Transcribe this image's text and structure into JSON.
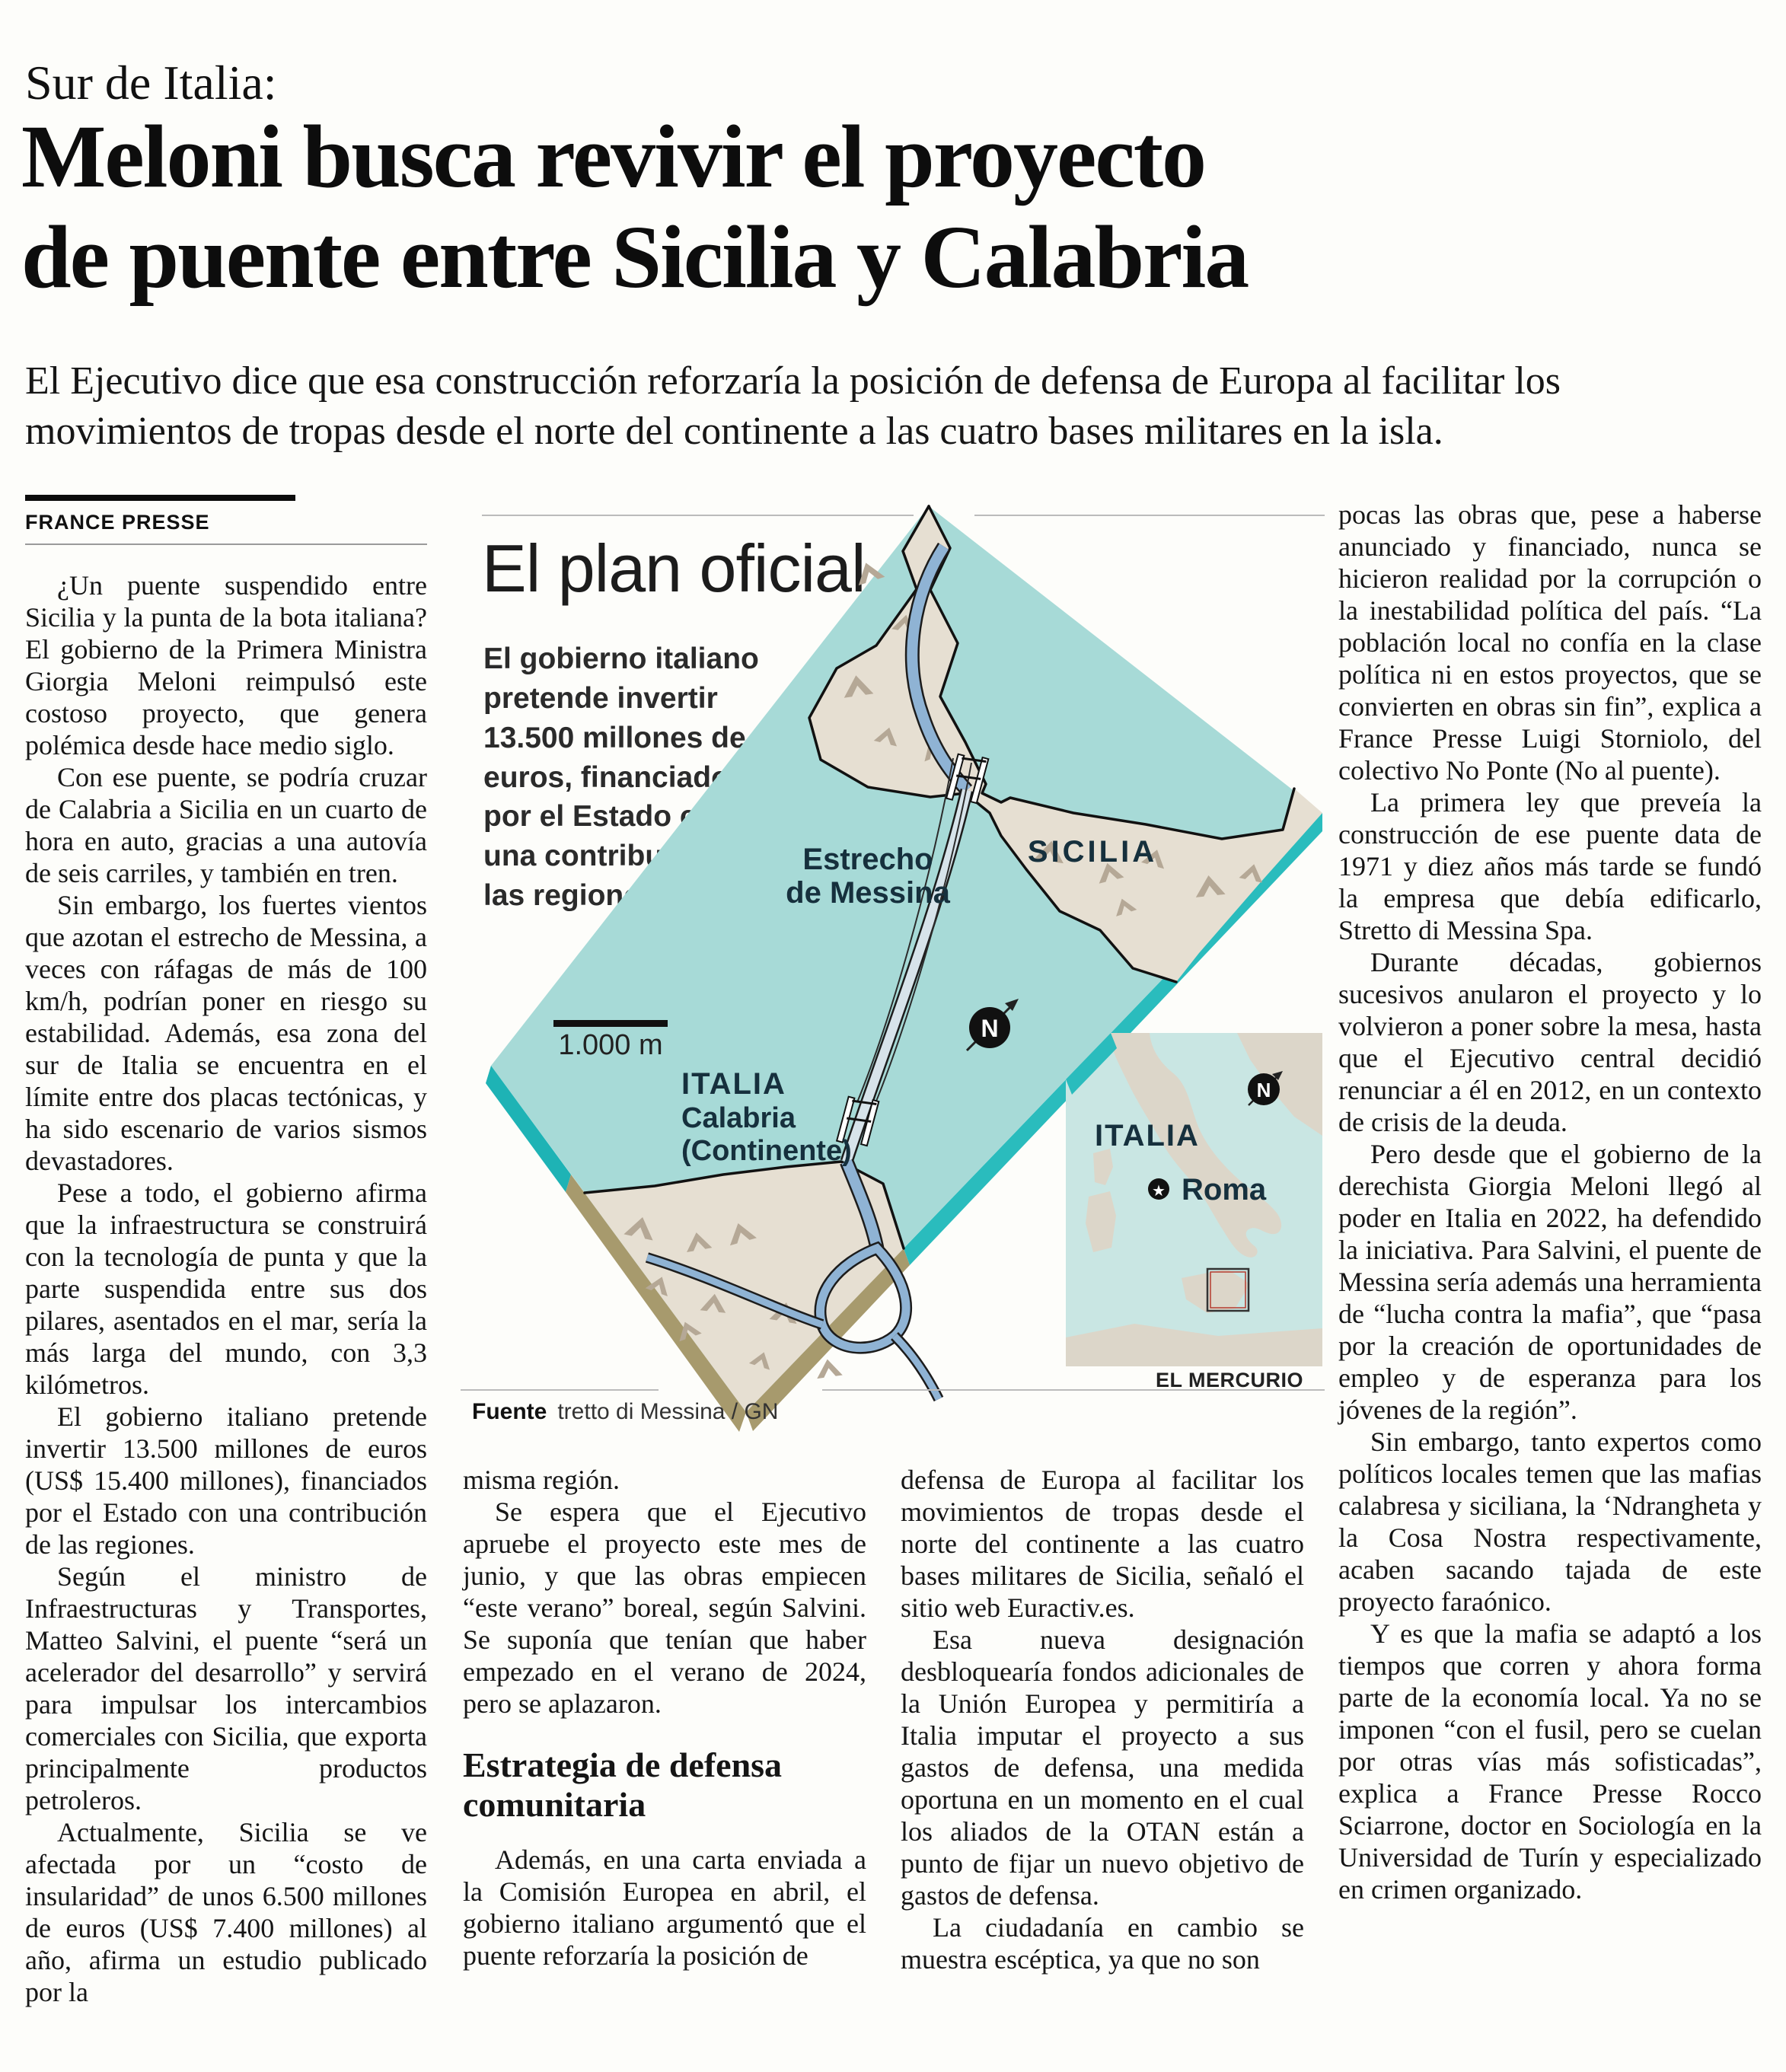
{
  "header": {
    "kicker": "Sur de Italia:",
    "headline_line1": "Meloni busca revivir el proyecto",
    "headline_line2": "de puente entre Sicilia y Calabria",
    "deck": "El Ejecutivo dice que esa construcción reforzaría la posición de defensa de Europa al facilitar los movimientos de tropas desde el norte del continente a las cuatro bases militares en la isla.",
    "byline": "FRANCE PRESSE"
  },
  "body": {
    "col1": [
      "¿Un puente suspendido entre Sicilia y la punta de la bota italiana? El gobierno de la Primera Ministra Giorgia Meloni reimpulsó este costoso proyecto, que genera polémica desde hace medio siglo.",
      "Con ese puente, se podría cruzar de Calabria a Sicilia en un cuarto de hora en auto, gracias a una autovía de seis carriles, y también en tren.",
      "Sin embargo, los fuertes vientos que azotan el estrecho de Messina, a veces con ráfagas de más de 100 km/h, podrían poner en riesgo su estabilidad. Además, esa zona del sur de Italia se encuentra en el límite entre dos placas tectónicas, y ha sido escenario de varios sismos devastadores.",
      "Pese a todo, el gobierno afirma que la infraestructura se construirá con la tecnología de punta y que la parte suspendida entre sus dos pilares, asentados en el mar, sería la más larga del mundo, con 3,3 kilómetros.",
      "El gobierno italiano pretende invertir 13.500 millones de euros (US$ 15.400 millones), financiados por el Estado con una contribución de las regiones.",
      "Según el ministro de Infraestructuras y Transportes, Matteo Salvini, el puente “será un acelerador del desarrollo” y servirá para impulsar los intercambios comerciales con Sicilia, que exporta principalmente productos petroleros.",
      "Actualmente, Sicilia se ve afectada por un “costo de insularidad” de unos 6.500 millones de euros (US$ 7.400 millones) al año, afirma un estudio publicado por la"
    ],
    "col2": [
      "misma región.",
      "Se espera que el Ejecutivo apruebe el proyecto este mes de junio, y que las obras empiecen “este verano” boreal, según Salvini. Se suponía que tenían que haber empezado en el verano de 2024, pero se aplazaron.",
      "Además, en una carta enviada a la Comisión Europea en abril, el gobierno italiano argumentó que el puente reforzaría la posición de"
    ],
    "subhead": "Estrategia de defensa comunitaria",
    "col3": [
      "defensa de Europa al facilitar los movimientos de tropas desde el norte del continente a las cuatro bases militares de Sicilia, señaló el sitio web Euractiv.es.",
      "Esa nueva designación desbloquearía fondos adicionales de la Unión Europea y permitiría a Italia imputar el proyecto a sus gastos de defensa, una medida oportuna en un momento en el cual los aliados de la OTAN están a punto de fijar un nuevo objetivo de gastos de defensa.",
      "La ciudadanía en cambio se muestra escéptica, ya que no son"
    ],
    "col4": [
      "pocas las obras que, pese a haberse anunciado y financiado, nunca se hicieron realidad por la corrupción o la inestabilidad política del país. “La población local no confía en la clase política ni en estos proyectos, que se convierten en obras sin fin”, explica a France Presse Luigi Storniolo, del colectivo No Ponte (No al puente).",
      "La primera ley que preveía la construcción de ese puente data de 1971 y diez años más tarde se fundó la empresa que debía edificarlo, Stretto di Messina Spa.",
      "Durante décadas, gobiernos sucesivos anularon el proyecto y lo volvieron a poner sobre la mesa, hasta que el Ejecutivo central decidió renunciar a él en 2012, en un contexto de crisis de la deuda.",
      "Pero desde que el gobierno de la derechista Giorgia Meloni llegó al poder en Italia en 2022, ha defendido la iniciativa. Para Salvini, el puente de Messina sería además una herramienta de “lucha contra la mafia”, que “pasa por la creación de oportunidades de empleo y de esperanza para los jóvenes de la región”.",
      "Sin embargo, tanto expertos como políticos locales temen que las mafias calabresa y siciliana, la ‘Ndrangheta y la Cosa Nostra respectivamente, acaben sacando tajada de este proyecto faraónico.",
      "Y es que la mafia se adaptó a los tiempos que corren y ahora forma parte de la economía local. Ya no se imponen “con el fusil, pero se cuelan por otras vías más sofisticadas”, explica a France Presse Rocco Sciarrone, doctor en Sociología en la Universidad de Turín y especializado en crimen organizado."
    ]
  },
  "infographic": {
    "title": "El plan oficial",
    "description": "El gobierno italiano pretende invertir 13.500 millones de euros, financiados por el Estado con una contribución de las regiones.",
    "scale_label": "1.000 m",
    "labels": {
      "strait_line1": "Estrecho",
      "strait_line2": "de Messina",
      "sicilia": "SICILIA",
      "italia_line1": "ITALIA",
      "italia_line2": "Calabria",
      "italia_line3": "(Continente)",
      "compass": "N"
    },
    "inset": {
      "italia": "ITALIA",
      "roma": "Roma",
      "compass": "N"
    },
    "credit": "EL MERCURIO",
    "source_label": "Fuente",
    "source": "tretto di Messina / GN",
    "colors": {
      "sea": "#a7dad7",
      "sea_edge": "#1eb3b5",
      "land": "#e6dfd2",
      "land_edge": "#a79a6d",
      "mountain": "#b5a896",
      "road": "#8fb3d4",
      "bridge_deck": "#d7e3ea",
      "label_navy": "#16303d",
      "inset_sea": "#c9e6e3",
      "inset_land": "#dcd6c9"
    }
  }
}
